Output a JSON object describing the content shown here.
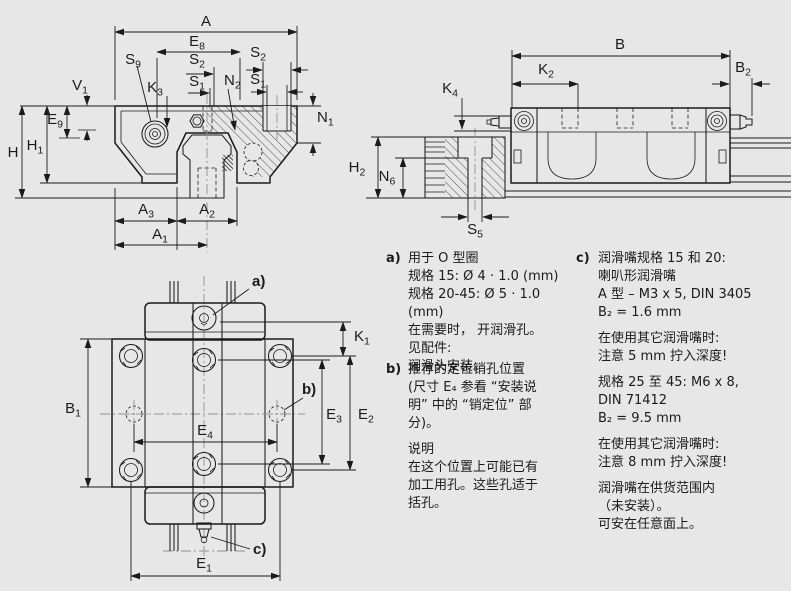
{
  "colors": {
    "background": "#e7e7e7",
    "ink": "#1b1b1b",
    "centerline": "#909090"
  },
  "dims": {
    "A": {
      "b": "A",
      "s": ""
    },
    "A1": {
      "b": "A",
      "s": "1"
    },
    "A2": {
      "b": "A",
      "s": "2"
    },
    "A3": {
      "b": "A",
      "s": "3"
    },
    "B": {
      "b": "B",
      "s": ""
    },
    "B1": {
      "b": "B",
      "s": "1"
    },
    "B2": {
      "b": "B",
      "s": "2"
    },
    "E1": {
      "b": "E",
      "s": "1"
    },
    "E2": {
      "b": "E",
      "s": "2"
    },
    "E3": {
      "b": "E",
      "s": "3"
    },
    "E4": {
      "b": "E",
      "s": "4"
    },
    "E8": {
      "b": "E",
      "s": "8"
    },
    "E9": {
      "b": "E",
      "s": "9"
    },
    "H": {
      "b": "H",
      "s": ""
    },
    "H1": {
      "b": "H",
      "s": "1"
    },
    "H2": {
      "b": "H",
      "s": "2"
    },
    "K1": {
      "b": "K",
      "s": "1"
    },
    "K2": {
      "b": "K",
      "s": "2"
    },
    "K3": {
      "b": "K",
      "s": "3"
    },
    "K4": {
      "b": "K",
      "s": "4"
    },
    "N1": {
      "b": "N",
      "s": "1"
    },
    "N2": {
      "b": "N",
      "s": "2"
    },
    "N6": {
      "b": "N",
      "s": "6"
    },
    "S1": {
      "b": "S",
      "s": "1"
    },
    "S2": {
      "b": "S",
      "s": "2"
    },
    "S5": {
      "b": "S",
      "s": "5"
    },
    "S9": {
      "b": "S",
      "s": "9"
    },
    "V1": {
      "b": "V",
      "s": "1"
    }
  },
  "callouts": {
    "a": "a)",
    "b": "b)",
    "c": "c)"
  },
  "notes": {
    "a": {
      "marker": "a)",
      "body": "用于 O 型圈\n规格 15: Ø 4 · 1.0 (mm)\n规格 20-45: Ø 5 · 1.0 (mm)\n在需要时， 开润滑孔。\n见配件:\n润滑头安装。"
    },
    "b": {
      "marker": "b)",
      "p1": "推荐的定位销孔位置\n(尺寸 E₄ 参看 “安装说\n明” 中的 “销定位” 部\n分)。",
      "p2": "说明\n在这个位置上可能已有\n加工用孔。这些孔适于\n括孔。"
    },
    "c": {
      "marker": "c)",
      "p1": "润滑嘴规格 15 和 20:\n喇叭形润滑嘴\nA 型 – M3 x 5, DIN 3405\nB₂ = 1.6 mm",
      "p2": "在使用其它润滑嘴时:\n注意 5 mm 拧入深度!",
      "p3": "规格 25 至 45: M6 x 8,\nDIN 71412\nB₂ = 9.5 mm",
      "p4": "在使用其它润滑嘴时:\n注意 8 mm 拧入深度!",
      "p5": "润滑嘴在供货范围内\n（未安装）。\n可安在任意面上。"
    }
  }
}
